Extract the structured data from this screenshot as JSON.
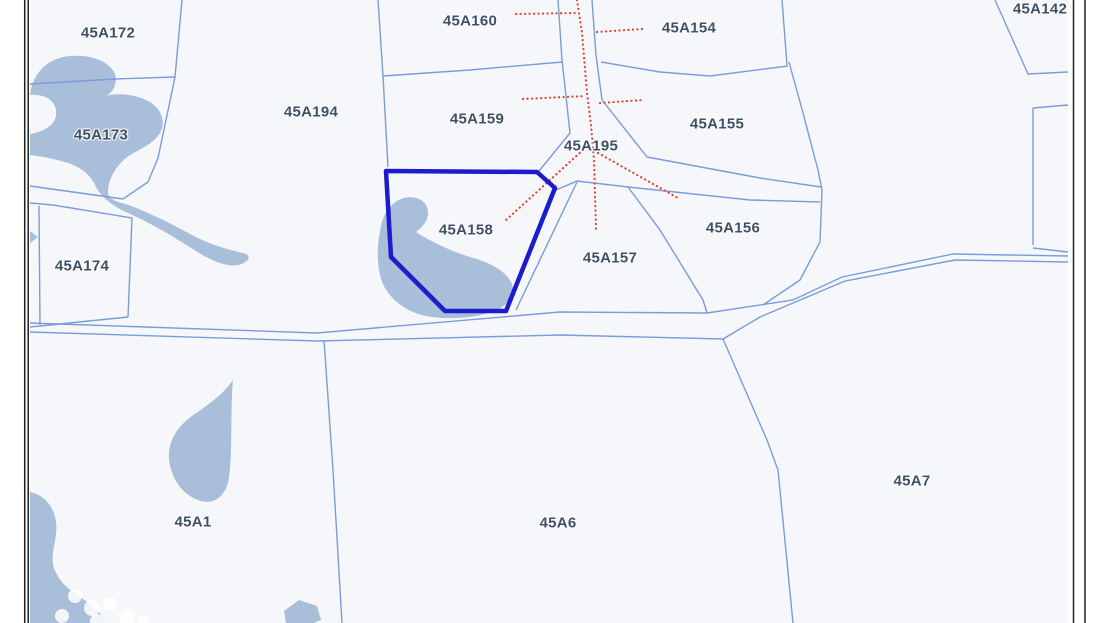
{
  "map": {
    "type": "cadastral-parcel-map",
    "selected_parcel": "45A158",
    "colors": {
      "map_background": "#f5f7fa",
      "margin_background": "#ffffff",
      "parcel_line": "#7b9cdb",
      "selection_outline": "#1c1ccd",
      "utility_dotted_line": "#e8402f",
      "water": "#a9bed8",
      "label_text": "#3e5068",
      "frame_edge": "#1f1f1f"
    },
    "labels": [
      {
        "text": "45A172",
        "x": 108,
        "y": 33
      },
      {
        "text": "45A173",
        "x": 101,
        "y": 135
      },
      {
        "text": "45A174",
        "x": 82,
        "y": 266
      },
      {
        "text": "45A194",
        "x": 311,
        "y": 112
      },
      {
        "text": "45A160",
        "x": 470,
        "y": 21
      },
      {
        "text": "45A159",
        "x": 477,
        "y": 119
      },
      {
        "text": "45A154",
        "x": 689,
        "y": 28
      },
      {
        "text": "45A155",
        "x": 717,
        "y": 124
      },
      {
        "text": "45A195",
        "x": 591,
        "y": 146
      },
      {
        "text": "45A158",
        "x": 466,
        "y": 230
      },
      {
        "text": "45A157",
        "x": 610,
        "y": 258
      },
      {
        "text": "45A156",
        "x": 733,
        "y": 228
      },
      {
        "text": "45A142",
        "x": 1040,
        "y": 9
      },
      {
        "text": "45A1",
        "x": 193,
        "y": 522
      },
      {
        "text": "45A6",
        "x": 558,
        "y": 523
      },
      {
        "text": "45A7",
        "x": 912,
        "y": 481
      }
    ]
  }
}
